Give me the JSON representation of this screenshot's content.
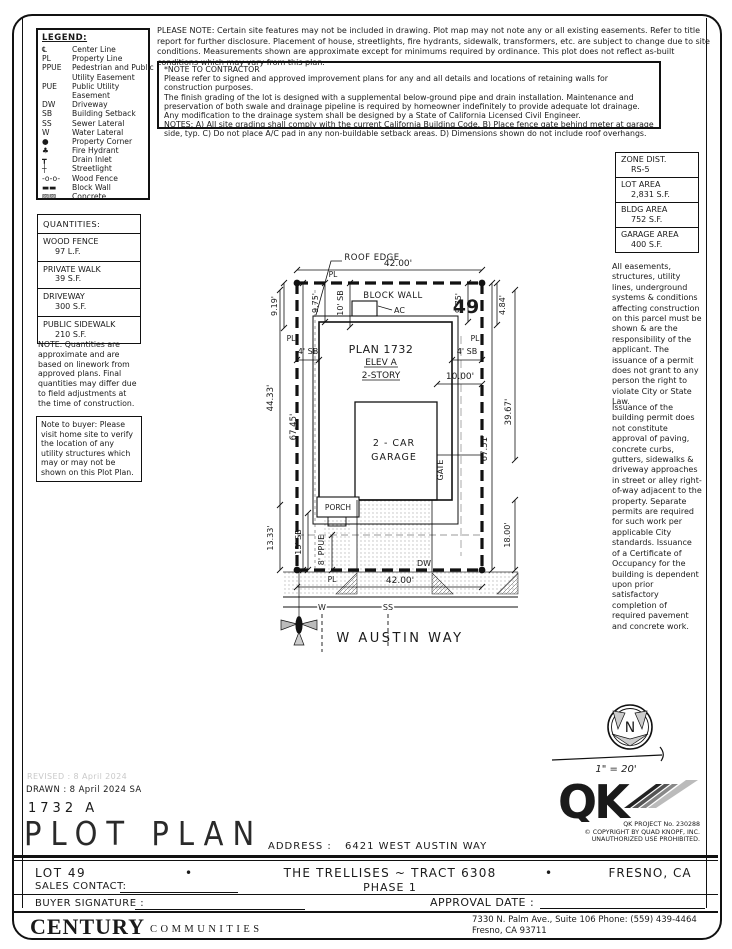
{
  "colors": {
    "ink": "#1a1a1a",
    "faint": "#c9c9c9",
    "gray": "#999999"
  },
  "legend": {
    "title": "LEGEND:",
    "items": [
      {
        "symbol": "℄",
        "label": "Center Line"
      },
      {
        "symbol": "PL",
        "label": "Property Line"
      },
      {
        "symbol": "PPUE",
        "label": "Pedestrian and Public",
        "label2": "Utility Easement"
      },
      {
        "symbol": "PUE",
        "label": "Public Utility",
        "label2": "Easement"
      },
      {
        "symbol": "DW",
        "label": "Driveway"
      },
      {
        "symbol": "SB",
        "label": "Building Setback"
      },
      {
        "symbol": "SS",
        "label": "Sewer Lateral"
      },
      {
        "symbol": "W",
        "label": "Water Lateral"
      },
      {
        "symbol": "●",
        "label": "Property Corner"
      },
      {
        "symbol": "♣",
        "label": "Fire Hydrant"
      },
      {
        "symbol": "┳",
        "label": "Drain Inlet"
      },
      {
        "symbol": "┼",
        "label": "Streetlight"
      },
      {
        "symbol": "-o-o-",
        "label": "Wood Fence"
      },
      {
        "symbol": "▬▬",
        "label": "Block Wall"
      },
      {
        "symbol": "▨▨",
        "label": "Concrete"
      }
    ]
  },
  "top_note": "PLEASE NOTE:  Certain site features may not be included in drawing.  Plot map may not note any or all existing easements. Refer to title report for further disclosure.  Placement of house, streetlights, fire hydrants, sidewalk, transformers, etc. are subject to change due to site conditions.  Measurements shown are approximate except for minimums required by ordinance.  This plot does not reflect as-built conditions which may vary from this plan.",
  "contractor_note": {
    "title": "*NOTE TO CONTRACTOR",
    "body1": "Please refer to signed and approved improvement plans for any and all details and locations of retaining walls for construction purposes.",
    "body2": "The finish grading of the lot is designed with a supplemental below-ground pipe and drain installation.  Maintenance and preservation of both swale and drainage pipeline is required by homeowner indefinitely to provide adequate lot drainage.  Any modification to the drainage system shall be designed by a State of California Licensed Civil Engineer.",
    "body3": "NOTES:  A) All site grading shall comply with the current California Building Code.  B) Place fence gate behind meter at garage side, typ.  C) Do not place A/C pad in any non-buildable setback areas.  D) Dimensions shown do not include roof overhangs."
  },
  "zone_box": {
    "rows": [
      {
        "label": "ZONE DIST.",
        "value": "RS-5"
      },
      {
        "label": "LOT AREA",
        "value": "2,831 S.F."
      },
      {
        "label": "BLDG AREA",
        "value": "752 S.F."
      },
      {
        "label": "GARAGE AREA",
        "value": "400 S.F."
      }
    ]
  },
  "quantities": {
    "title": "QUANTITIES:",
    "rows": [
      {
        "label": "WOOD FENCE",
        "value": "97 L.F."
      },
      {
        "label": "PRIVATE WALK",
        "value": "39 S.F."
      },
      {
        "label": "DRIVEWAY",
        "value": "300 S.F."
      },
      {
        "label": "PUBLIC SIDEWALK",
        "value": "210 S.F."
      }
    ]
  },
  "notes": {
    "quantities_note": "NOTE: Quantities are approximate and are based on linework from approved plans.  Final quantities may differ due to field adjustments at the time of construction.",
    "buyer_note": "Note to buyer: Please visit home site to verify the location of any utility structures which may or may not be shown on this Plot Plan.",
    "right_para1": "All easements, structures, utility lines, underground systems & conditions affecting construction on this parcel must be shown & are the responsibility of the applicant. The issuance of a permit does not grant to any person the right to violate City or State Law.",
    "right_para2": "Issuance of the building permit does not constitute approval of paving, concrete curbs, gutters, sidewalks & driveway approaches in street or alley right-of-way adjacent to the property. Separate permits are required for such work per applicable City standards. Issuance of a Certificate of Occupancy for the building is dependent upon prior satisfactory completion of required pavement and concrete work."
  },
  "plot": {
    "roof_edge": "ROOF EDGE",
    "pl": "PL",
    "dim_width_top": "42.00'",
    "block_wall": "BLOCK WALL",
    "lot_number": "49",
    "ac": "AC",
    "dim_919": "9.19'",
    "dim_975_left": "9.75'",
    "dim_10sb": "10' SB",
    "dim_975_right": "9.75'",
    "dim_484": "4.84'",
    "sb4_left": "4' SB",
    "sb4_right": "4' SB",
    "plan_name": "PLAN 1732",
    "elevation": "ELEV A",
    "stories": "2-STORY",
    "dim_1000": "10.00'",
    "dim_4433": "44.33'",
    "dim_6745": "67.45'",
    "garage_line1": "2 - CAR",
    "garage_line2": "GARAGE",
    "gate": "GATE",
    "dim_3967": "39.67'",
    "dim_6751": "67.51'",
    "porch": "PORCH",
    "dim_1333": "13.33'",
    "sb13": "13' SB",
    "ppue": "8' PPUE",
    "dw": "DW",
    "dim_width_bottom": "42.00'",
    "dim_1800": "18.00'",
    "water": "W",
    "sewer": "SS",
    "street_name": "W AUSTIN WAY"
  },
  "north": {
    "n": "N",
    "scale": "1\" = 20'"
  },
  "title_block": {
    "revised": "REVISED :  8 April 2024",
    "drawn": "DRAWN :  8 April 2024  SA",
    "plan_id": "1732  A",
    "title": "PLOT PLAN",
    "address_label": "ADDRESS :",
    "address": "6421 WEST AUSTIN WAY"
  },
  "qk": {
    "initials": "QK",
    "project_no": "QK PROJECT No. 230288",
    "copyright": "©  COPYRIGHT BY QUAD KNOPF, INC.",
    "rights": "UNAUTHORIZED USE PROHIBITED."
  },
  "footer": {
    "lot": "LOT 49",
    "bullet": "•",
    "community": "THE TRELLISES ~ TRACT 6308",
    "phase": "PHASE 1",
    "city": "FRESNO, CA",
    "sales_label": "SALES CONTACT:",
    "buyer_label": "BUYER SIGNATURE :",
    "approval_label": "APPROVAL DATE :",
    "brand_main": "CENTURY",
    "brand_sub": "COMMUNITIES",
    "office_line1": "7330 N. Palm Ave., Suite 106    Phone:  (559) 439-4464",
    "office_line2": "Fresno, CA  93711"
  }
}
